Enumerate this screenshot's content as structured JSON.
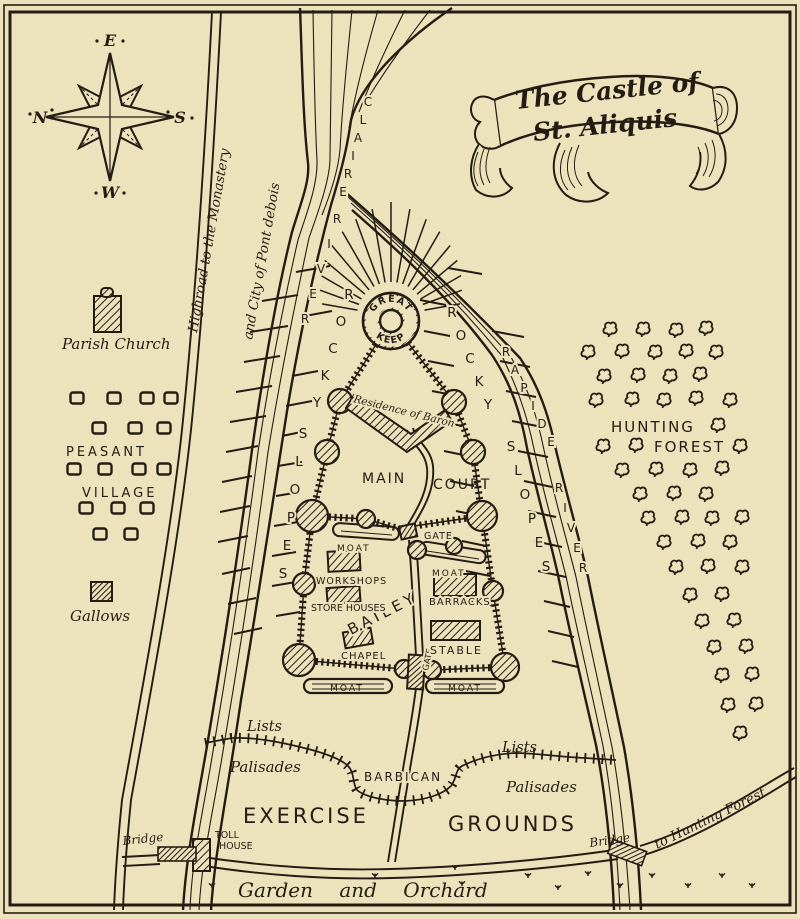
{
  "title": {
    "line1": "The Castle of",
    "line2": "St. Aliquis"
  },
  "compass": {
    "east": "E",
    "north": "N",
    "south": "S",
    "west": "W"
  },
  "roads": {
    "highroad_line1": "Highroad to the Monastery",
    "highroad_line2": "and City of Pont debois",
    "to_hunting_forest": "to Hunting Forest",
    "bridge_left": "Bridge",
    "bridge_right": "Bridge",
    "toll_house_line1": "TOLL",
    "toll_house_line2": "HOUSE"
  },
  "rivers": {
    "claire": "CLAIRE",
    "claire_river": "RIVER",
    "rapide": "RAPIDE",
    "rapide_river": "RIVER"
  },
  "slopes": {
    "rocky": "ROCKY",
    "slopes": "SLOPES"
  },
  "castle": {
    "keep_top": "GREAT",
    "keep_bottom": "KEEP",
    "residence": "Residence of Baron",
    "main_court_word1": "MAIN",
    "main_court_word2": "COURT",
    "bailey": "BAILEY",
    "gate_middle": "GATE",
    "gate_bottom": "GATE",
    "moat_left_mid": "MOAT",
    "moat_right_mid": "MOAT",
    "moat_left_bottom": "MOAT",
    "moat_right_bottom": "MOAT",
    "workshops": "WORKSHOPS",
    "store_houses": "STORE HOUSES",
    "barracks": "BARRACKS",
    "chapel": "CHAPEL",
    "stable": "STABLE"
  },
  "village": {
    "church": "Parish Church",
    "peasant": "PEASANT",
    "village": "VILLAGE",
    "gallows": "Gallows"
  },
  "forest": {
    "word1": "HUNTING",
    "word2": "FOREST"
  },
  "outworks": {
    "lists_left": "Lists",
    "lists_right": "Lists",
    "palisades_left": "Palisades",
    "palisades_right": "Palisades",
    "barbican": "BARBICAN",
    "exercise": "EXERCISE",
    "grounds": "GROUNDS"
  },
  "bottom": {
    "garden": "Garden and Orchard"
  },
  "colors": {
    "paper": "#ece3bd",
    "ink": "#241c12"
  }
}
